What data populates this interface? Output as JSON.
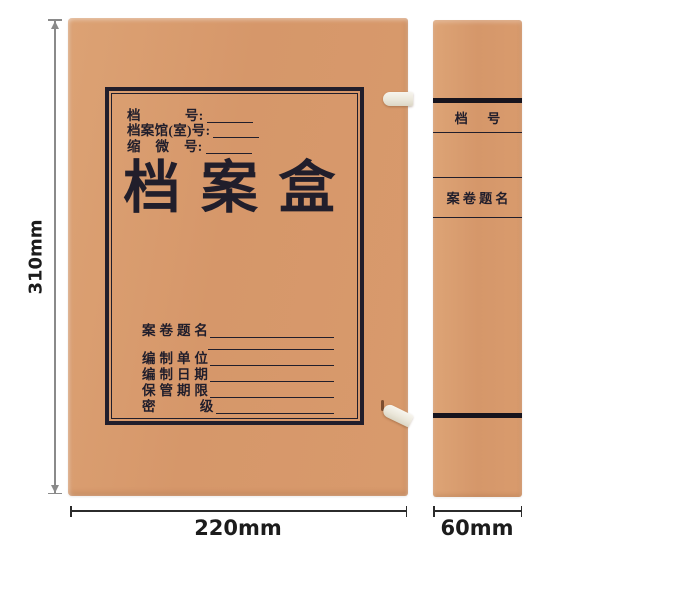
{
  "box": {
    "colors": {
      "kraft": "#d8996b",
      "ink": "#211e2b",
      "strap": "#f0ede2",
      "dimline": "#8a8a8a",
      "dimtext": "#1c1c1c"
    },
    "front": {
      "header_fields": [
        {
          "label": "档            号:"
        },
        {
          "label": "档案馆(室)号:"
        },
        {
          "label": "缩    微    号:"
        }
      ],
      "title": "档案盒",
      "body_fields": [
        {
          "label": "案 卷 题 名"
        },
        {
          "label": ""
        },
        {
          "label": "编 制 单 位"
        },
        {
          "label": "编 制 日 期"
        },
        {
          "label": "保 管 期 限"
        },
        {
          "label": "密            级"
        }
      ]
    },
    "spine": {
      "file_number_label": "档      号",
      "volume_title_label": "案 卷 题 名"
    }
  },
  "dimensions": {
    "height": "310mm",
    "width": "220mm",
    "depth": "60mm"
  }
}
